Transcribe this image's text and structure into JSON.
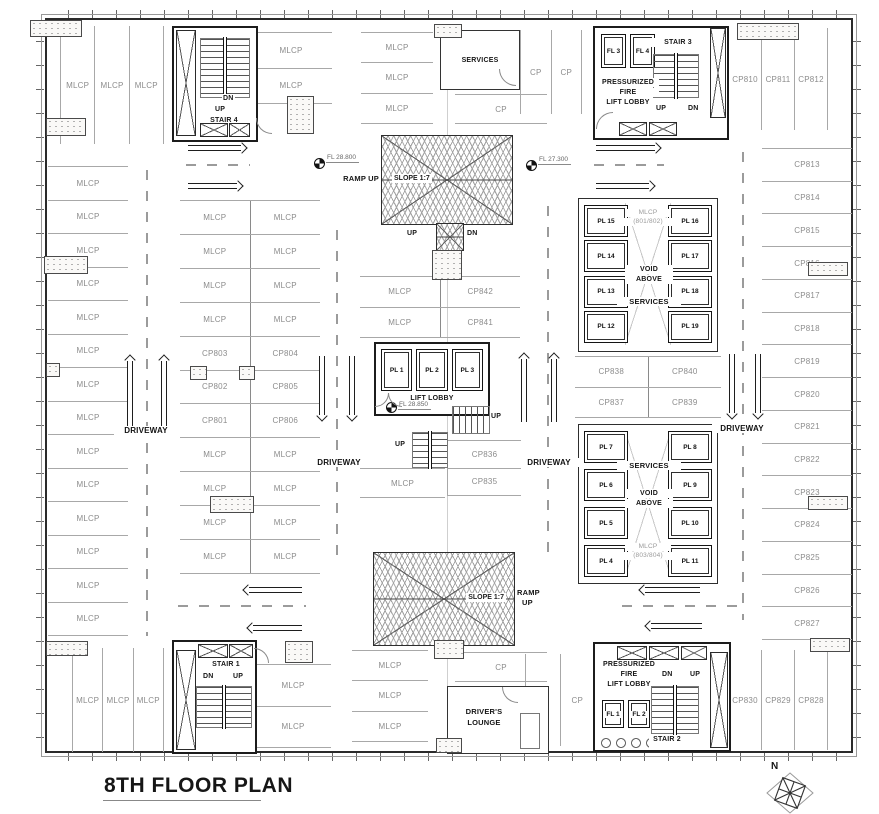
{
  "title": "8TH FLOOR PLAN",
  "compass": {
    "label": "N"
  },
  "driveways": {
    "label": "DRIVEWAY"
  },
  "levels": {
    "ramp_up_left": "FL 28.800",
    "ramp_up_right": "FL 27.300",
    "lift_lobby": "FL 28.850"
  },
  "ramps": {
    "upper": {
      "ramp_label": "RAMP UP",
      "slope_label": "SLOPE 1:7",
      "up": "UP",
      "dn": "DN"
    },
    "lower": {
      "slope_label": "SLOPE 1:7",
      "ramp_label_line1": "RAMP",
      "ramp_label_line2": "UP"
    }
  },
  "rooms": {
    "services_top": "SERVICES",
    "drivers_lounge_line1": "DRIVER'S",
    "drivers_lounge_line2": "LOUNGE"
  },
  "cores": {
    "stair4": {
      "name": "STAIR 4",
      "dn": "DN",
      "up": "UP"
    },
    "stair3": {
      "name": "STAIR 3",
      "up": "UP",
      "dn": "DN",
      "lifts": [
        "FL 3",
        "FL 4"
      ],
      "lobby_line1": "PRESSURIZED",
      "lobby_line2": "FIRE",
      "lobby_line3": "LIFT LOBBY"
    },
    "stair1": {
      "name": "STAIR 1",
      "dn": "DN",
      "up": "UP"
    },
    "stair2": {
      "name": "STAIR 2",
      "dn": "DN",
      "up": "UP",
      "lifts": [
        "FL 1",
        "FL 2"
      ],
      "lobby_line1": "PRESSURIZED",
      "lobby_line2": "FIRE",
      "lobby_line3": "LIFT LOBBY"
    },
    "lift_bank": {
      "lifts": [
        "PL 1",
        "PL 2",
        "PL 3"
      ],
      "lobby": "LIFT LOBBY",
      "up_right": "UP",
      "up_bottom": "UP"
    },
    "upper_right": {
      "left_lifts": [
        "PL 15",
        "PL 14",
        "PL 13",
        "PL 12"
      ],
      "right_lifts": [
        "PL 16",
        "PL 17",
        "PL 18",
        "PL 19"
      ],
      "top_label_line1": "MLCP",
      "top_label_line2": "(801/802)",
      "void_line1": "VOID",
      "void_line2": "ABOVE",
      "services": "SERVICES"
    },
    "lower_right": {
      "left_lifts": [
        "PL 7",
        "PL 6",
        "PL 5",
        "PL 4"
      ],
      "right_lifts": [
        "PL 8",
        "PL 9",
        "PL 10",
        "PL 11"
      ],
      "services": "SERVICES",
      "void_line1": "VOID",
      "void_line2": "ABOVE",
      "bottom_label_line1": "MLCP",
      "bottom_label_line2": "(803/804)"
    }
  },
  "stalls": {
    "top_left": [
      "MLCP",
      "MLCP",
      "MLCP"
    ],
    "top_left_inner": [
      "MLCP",
      "MLCP"
    ],
    "top_mid": [
      "MLCP",
      "MLCP",
      "MLCP"
    ],
    "top_cp_pair": [
      "CP",
      "CP"
    ],
    "top_cp_single": "CP",
    "top_right": [
      "CP810",
      "CP811",
      "CP812"
    ],
    "right_col": [
      "CP813",
      "CP814",
      "CP815",
      "CP816",
      "CP817",
      "CP818",
      "CP819",
      "CP820",
      "CP821",
      "CP822",
      "CP823",
      "CP824",
      "CP825",
      "CP826",
      "CP827"
    ],
    "left_col": [
      "MLCP",
      "MLCP",
      "MLCP",
      "MLCP",
      "MLCP",
      "MLCP",
      "MLCP",
      "MLCP",
      "MLCP",
      "MLCP",
      "MLCP",
      "MLCP",
      "MLCP",
      "MLCP"
    ],
    "center_grid": [
      [
        "MLCP",
        "MLCP"
      ],
      [
        "MLCP",
        "MLCP"
      ],
      [
        "MLCP",
        "MLCP"
      ],
      [
        "MLCP",
        "MLCP"
      ],
      [
        "CP803",
        "CP804"
      ],
      [
        "CP802",
        "CP805"
      ],
      [
        "CP801",
        "CP806"
      ],
      [
        "MLCP",
        "MLCP"
      ],
      [
        "MLCP",
        "MLCP"
      ],
      [
        "MLCP",
        "MLCP"
      ],
      [
        "MLCP",
        "MLCP"
      ]
    ],
    "mid_pair_top": [
      [
        "MLCP",
        "CP842"
      ],
      [
        "MLCP",
        "CP841"
      ]
    ],
    "mid_col_bottom": [
      "CP836",
      "CP835"
    ],
    "mid_mlcp_bottom": "MLCP",
    "cp_block_mid": [
      [
        "CP838",
        "CP840"
      ],
      [
        "CP837",
        "CP839"
      ]
    ],
    "bottom_left": [
      "MLCP",
      "MLCP",
      "MLCP"
    ],
    "bottom_left_inner": [
      "MLCP",
      "MLCP"
    ],
    "bottom_mid": [
      "MLCP",
      "MLCP",
      "MLCP"
    ],
    "bottom_cp_single": "CP",
    "bottom_cp_pair": [
      "CP",
      "CP"
    ],
    "bottom_right": [
      "CP830",
      "CP829",
      "CP828"
    ]
  },
  "colors": {
    "wall_line": "#2b2b2b",
    "stall_line": "#a8a8a8",
    "stall_label": "#8c8c8c",
    "text": "#161616"
  }
}
